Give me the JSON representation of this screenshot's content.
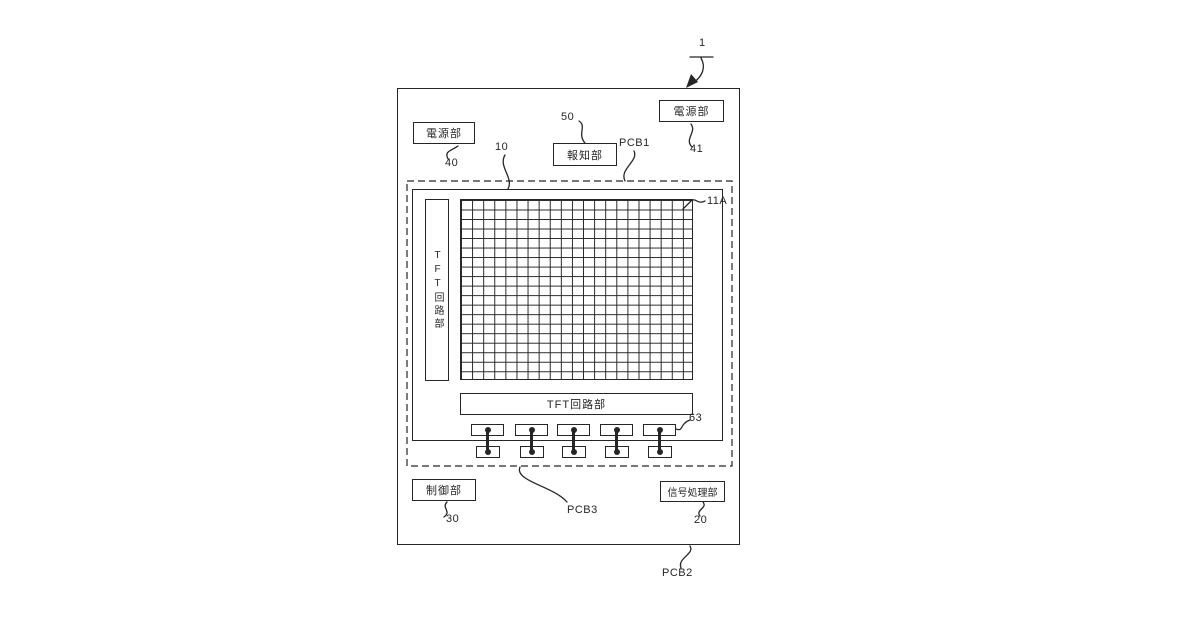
{
  "figure": {
    "ref_device": "1",
    "ref_panel": "10",
    "ref_array": "11A",
    "ref_connector": "63",
    "labels": {
      "pcb1": "PCB1",
      "pcb2": "PCB2",
      "pcb3": "PCB3"
    },
    "blocks": {
      "power_left": {
        "text": "電源部",
        "ref": "40"
      },
      "power_right": {
        "text": "電源部",
        "ref": "41"
      },
      "notifier": {
        "text": "報知部",
        "ref": "50"
      },
      "control": {
        "text": "制御部",
        "ref": "30"
      },
      "signal_processor": {
        "text": "信号処理部",
        "ref": "20"
      },
      "tft_gate": {
        "text": "TFT回路部"
      },
      "tft_data": {
        "text": "TFT回路部"
      }
    },
    "pixel_grid": {
      "columns": 21,
      "rows": 19
    },
    "connector_count": 5
  },
  "colors": {
    "line": "#262626",
    "background": "#ffffff"
  }
}
